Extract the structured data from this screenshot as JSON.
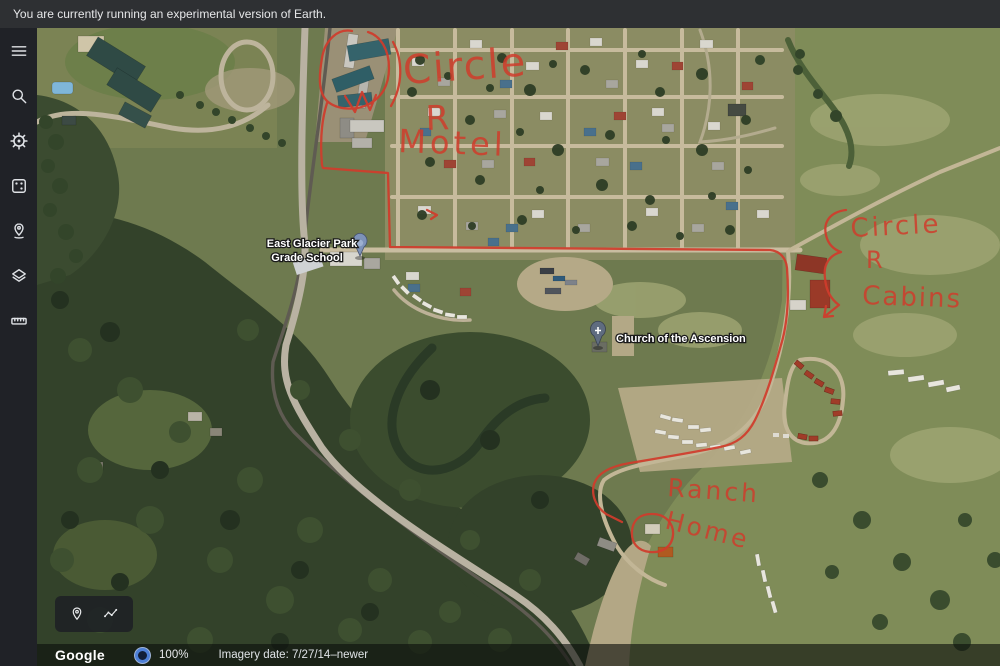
{
  "banner": {
    "message": "You are currently running an experimental version of Earth."
  },
  "sidebar": {
    "icons": [
      {
        "name": "menu"
      },
      {
        "name": "search"
      },
      {
        "name": "voyager"
      },
      {
        "name": "feeling-lucky"
      },
      {
        "name": "my-places"
      },
      {
        "name": "map-style"
      },
      {
        "name": "measure"
      }
    ]
  },
  "map": {
    "poi_labels": [
      {
        "id": "school",
        "line1": "East Glacier Park",
        "line2": "Grade School"
      },
      {
        "id": "church",
        "line1": "Church of the Ascension"
      }
    ],
    "annotations": {
      "ink_color": "#d03c2c",
      "motel": {
        "line1": "Circle",
        "line2": "R",
        "line3": "Motel"
      },
      "cabins": {
        "line1": "Circle",
        "line2": "R",
        "line3": "Cabins"
      },
      "ranch": {
        "line1": "Ranch",
        "line2": "Home"
      }
    }
  },
  "mini_toolbar": {
    "icons": [
      {
        "name": "my-location"
      },
      {
        "name": "path"
      }
    ]
  },
  "status_bar": {
    "brand": "Google",
    "zoom_level": "100%",
    "imagery_date": "Imagery date: 7/27/14–newer"
  }
}
